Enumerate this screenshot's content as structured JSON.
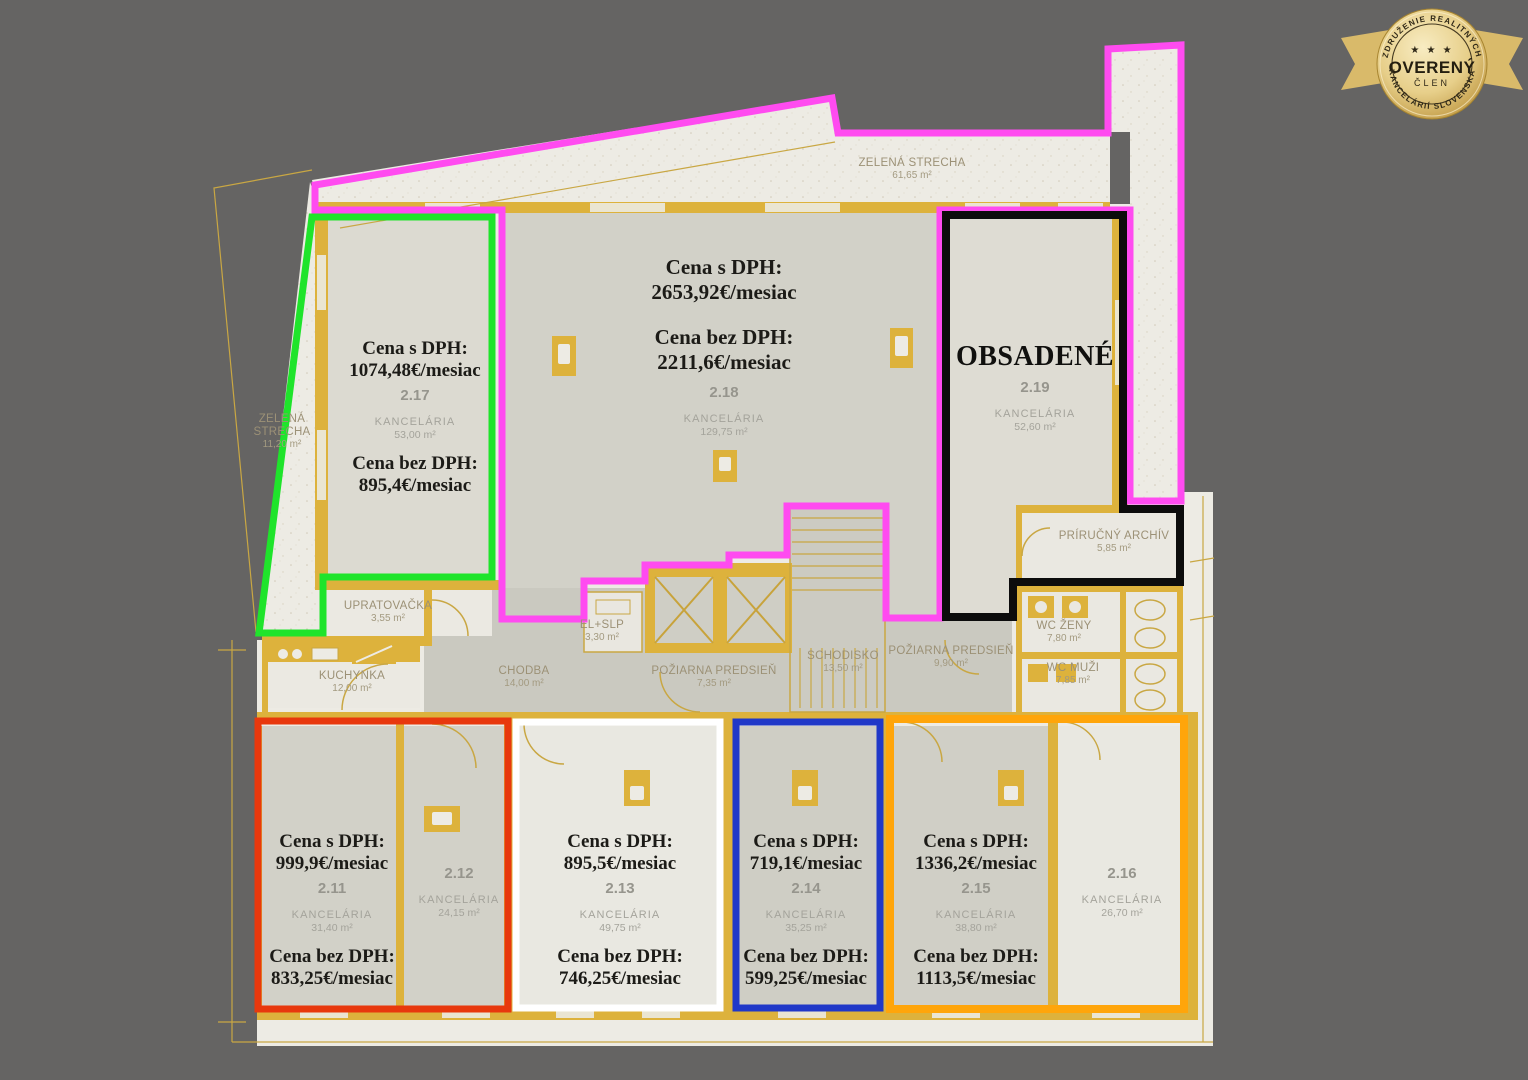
{
  "page": {
    "background": "#656463"
  },
  "colors": {
    "outline_magenta": "#FF4BF0",
    "outline_green": "#1FE42B",
    "outline_black": "#0C0C0C",
    "outline_red": "#E8380D",
    "outline_white": "#FFFFFF",
    "outline_blue": "#2038C8",
    "outline_orange": "#FFA50A",
    "wall_gold": "#DDB23C",
    "paper_cream": "#EDEBE4"
  },
  "badge": {
    "arc_top": "ZDRUŽENIE REALITNÝCH",
    "stars": "★ ★ ★",
    "title": "OVERENÝ",
    "member": "ČLEN",
    "arc_bottom": "KANCELÁRIÍ SLOVENSKA"
  },
  "labels": {
    "price_with_vat": "Cena s DPH:",
    "price_without_vat": "Cena bez DPH:"
  },
  "units": {
    "u211": {
      "number": "2.11",
      "type": "KANCELÁRIA",
      "area": "31,40 m²",
      "price_with_vat": "999,9€/mesiac",
      "price_without_vat": "833,25€/mesiac"
    },
    "u212": {
      "number": "2.12",
      "type": "KANCELÁRIA",
      "area": "24,15 m²"
    },
    "u213": {
      "number": "2.13",
      "type": "KANCELÁRIA",
      "area": "49,75 m²",
      "price_with_vat": "895,5€/mesiac",
      "price_without_vat": "746,25€/mesiac"
    },
    "u214": {
      "number": "2.14",
      "type": "KANCELÁRIA",
      "area": "35,25 m²",
      "price_with_vat": "719,1€/mesiac",
      "price_without_vat": "599,25€/mesiac"
    },
    "u215": {
      "number": "2.15",
      "type": "KANCELÁRIA",
      "area": "38,80 m²",
      "price_with_vat": "1336,2€/mesiac",
      "price_without_vat": "1113,5€/mesiac"
    },
    "u216": {
      "number": "2.16",
      "type": "KANCELÁRIA",
      "area": "26,70 m²"
    },
    "u217": {
      "number": "2.17",
      "type": "KANCELÁRIA",
      "area": "53,00 m²",
      "price_with_vat": "1074,48€/mesiac",
      "price_without_vat": "895,4€/mesiac"
    },
    "u218": {
      "number": "2.18",
      "type": "KANCELÁRIA",
      "area": "129,75 m²",
      "price_with_vat": "2653,92€/mesiac",
      "price_without_vat": "2211,6€/mesiac"
    },
    "u219": {
      "number": "2.19",
      "type": "KANCELÁRIA",
      "area": "52,60 m²",
      "status": "OBSADENÉ"
    }
  },
  "areas": {
    "roof_top": {
      "name": "ZELENÁ STRECHA",
      "area": "61,65 m²"
    },
    "roof_left": {
      "name_line1": "ZELENÁ",
      "name_line2": "STRECHA",
      "area": "11,20 m²"
    },
    "upratovacka": {
      "name": "UPRATOVAČKA",
      "area": "3,55 m²"
    },
    "kuchynka": {
      "name": "KUCHYNKA",
      "area": "12,00 m²"
    },
    "chodba": {
      "name": "CHODBA",
      "area": "14,00 m²"
    },
    "el_slp": {
      "name": "EL+SLP",
      "area": "3,30 m²"
    },
    "poziarna_predsien_1": {
      "name": "POŽIARNA PREDSIEŇ",
      "area": "7,35 m²"
    },
    "schodisko": {
      "name": "SCHODISKO",
      "area": "13,50 m²"
    },
    "poziarna_predsien_2": {
      "name": "POŽIARNA PREDSIEŇ",
      "area": "9,90 m²"
    },
    "wc_zeny": {
      "name": "WC ŽENY",
      "area": "7,80 m²"
    },
    "wc_muzi": {
      "name": "WC MUŽI",
      "area": "7,85 m²"
    },
    "archiv": {
      "name": "PRÍRUČNÝ ARCHÍV",
      "area": "5,85 m²"
    }
  }
}
